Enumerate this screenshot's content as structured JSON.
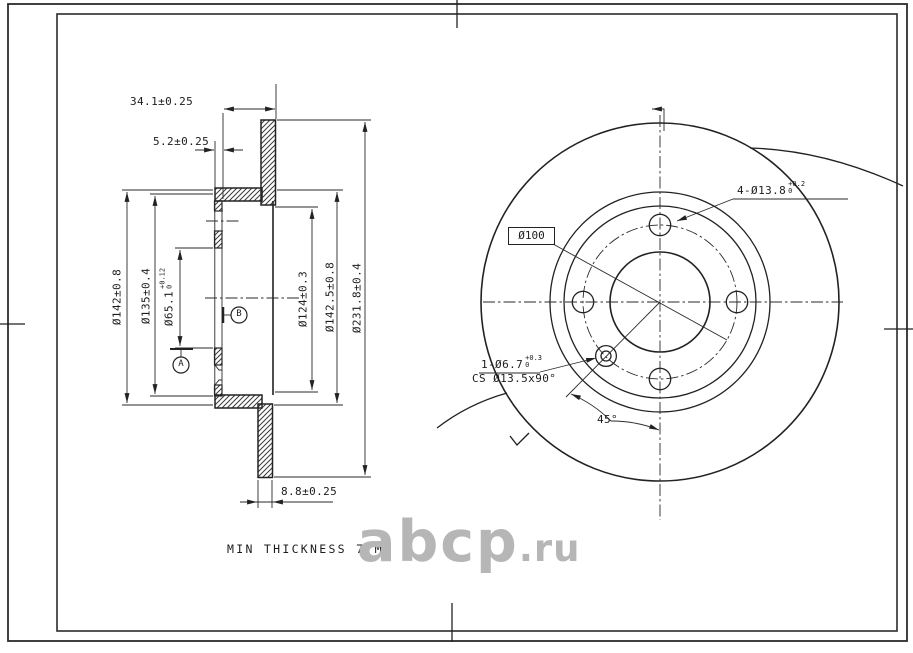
{
  "drawing_type": "brake disc technical drawing",
  "section_view": {
    "dim_overall_width": "34.1±0.25",
    "dim_flange_thickness": "5.2±0.25",
    "dim_disc_thickness": "8.8±0.25",
    "dia_142": "Ø142±0.8",
    "dia_135": "Ø135±0.4",
    "dia_65": {
      "main": "Ø65.1",
      "tol_upper": "+0.12",
      "tol_lower": "0"
    },
    "dia_124": "Ø124±0.3",
    "dia_142_5": "Ø142.5±0.8",
    "dia_231_8": "Ø231.8±0.4",
    "datum_a": "A",
    "datum_b": "B"
  },
  "plan_view": {
    "bolt_circle_label": "Ø100",
    "bolt_holes": {
      "main": "4-Ø13.8",
      "tol_upper": "+0.2",
      "tol_lower": "0"
    },
    "cs_hole_line1": {
      "main": "1-Ø6.7",
      "tol_upper": "+0.3",
      "tol_lower": "0"
    },
    "cs_hole_line2": "CS Ø13.5x90°",
    "angle_label": "45°"
  },
  "notes": {
    "min_thickness": "MIN THICKNESS 7 MM"
  },
  "watermark": {
    "name": "abcp",
    "tld": ".ru"
  },
  "colors": {
    "line": "#222222",
    "watermark": "#b6b6b6",
    "paper": "#ffffff"
  }
}
